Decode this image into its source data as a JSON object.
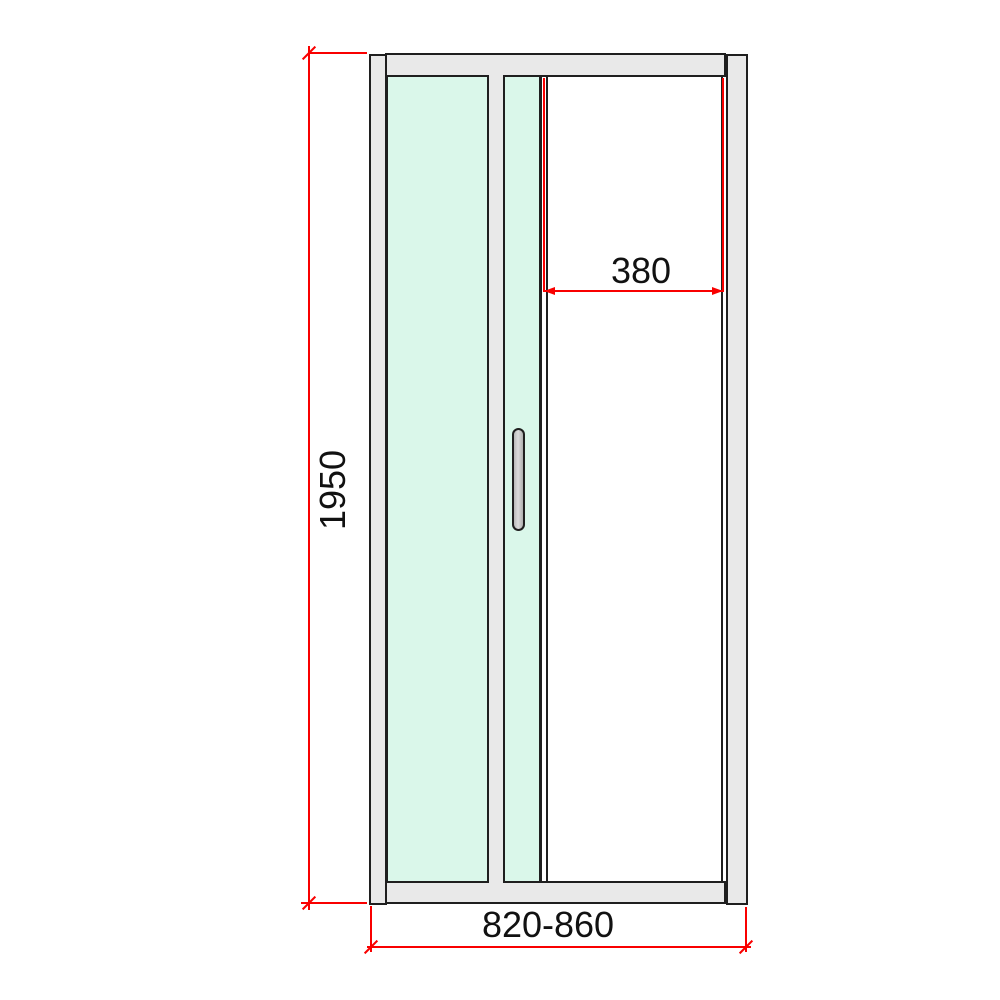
{
  "drawing": {
    "title": "sliding-shower-door-technical-drawing",
    "colors": {
      "background": "#ffffff",
      "outline": "#1f1f1f",
      "profile_fill": "#e9e9e9",
      "glass_fill": "#daf7ea",
      "handle_fill": "#c6c6c6",
      "dimension_red": "#f90000",
      "label_text": "#111111"
    },
    "dimensions": {
      "height": {
        "label": "1950"
      },
      "opening": {
        "label": "380"
      },
      "width": {
        "label": "820-860"
      }
    }
  }
}
